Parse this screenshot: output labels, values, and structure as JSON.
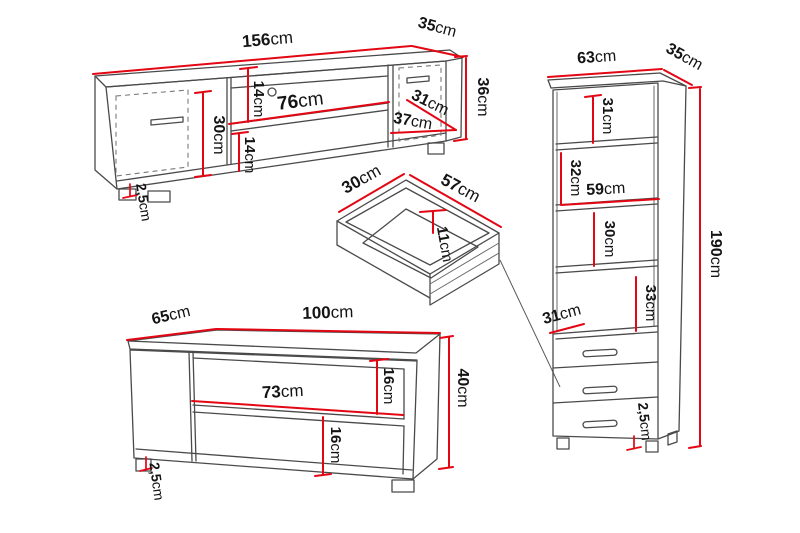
{
  "unit": "cm",
  "colors": {
    "dimension_red": "#e30613",
    "outline_gray": "#4a4a4a",
    "text_black": "#141414",
    "background": "#ffffff"
  },
  "tv_stand": {
    "width": "156",
    "depth": "35",
    "height": "36",
    "top_gap": "14",
    "shelf_width": "76",
    "bottom_gap": "14",
    "door_height": "30",
    "door_width": "31",
    "base_depth": "37",
    "foot_height": "2,5"
  },
  "drawer": {
    "depth": "30",
    "width": "57",
    "height": "11"
  },
  "coffee_table": {
    "depth": "65",
    "width": "100",
    "height": "40",
    "top_gap": "16",
    "shelf_width": "73",
    "bottom_gap": "16",
    "foot_height": "2,5"
  },
  "cabinet": {
    "width": "63",
    "depth": "35",
    "height": "190",
    "shelf_gap_1": "31",
    "shelf_gap_2": "32",
    "shelf_width": "59",
    "shelf_gap_3": "30",
    "shelf_gap_4": "33",
    "drawer_depth": "31",
    "foot_height": "2,5"
  }
}
